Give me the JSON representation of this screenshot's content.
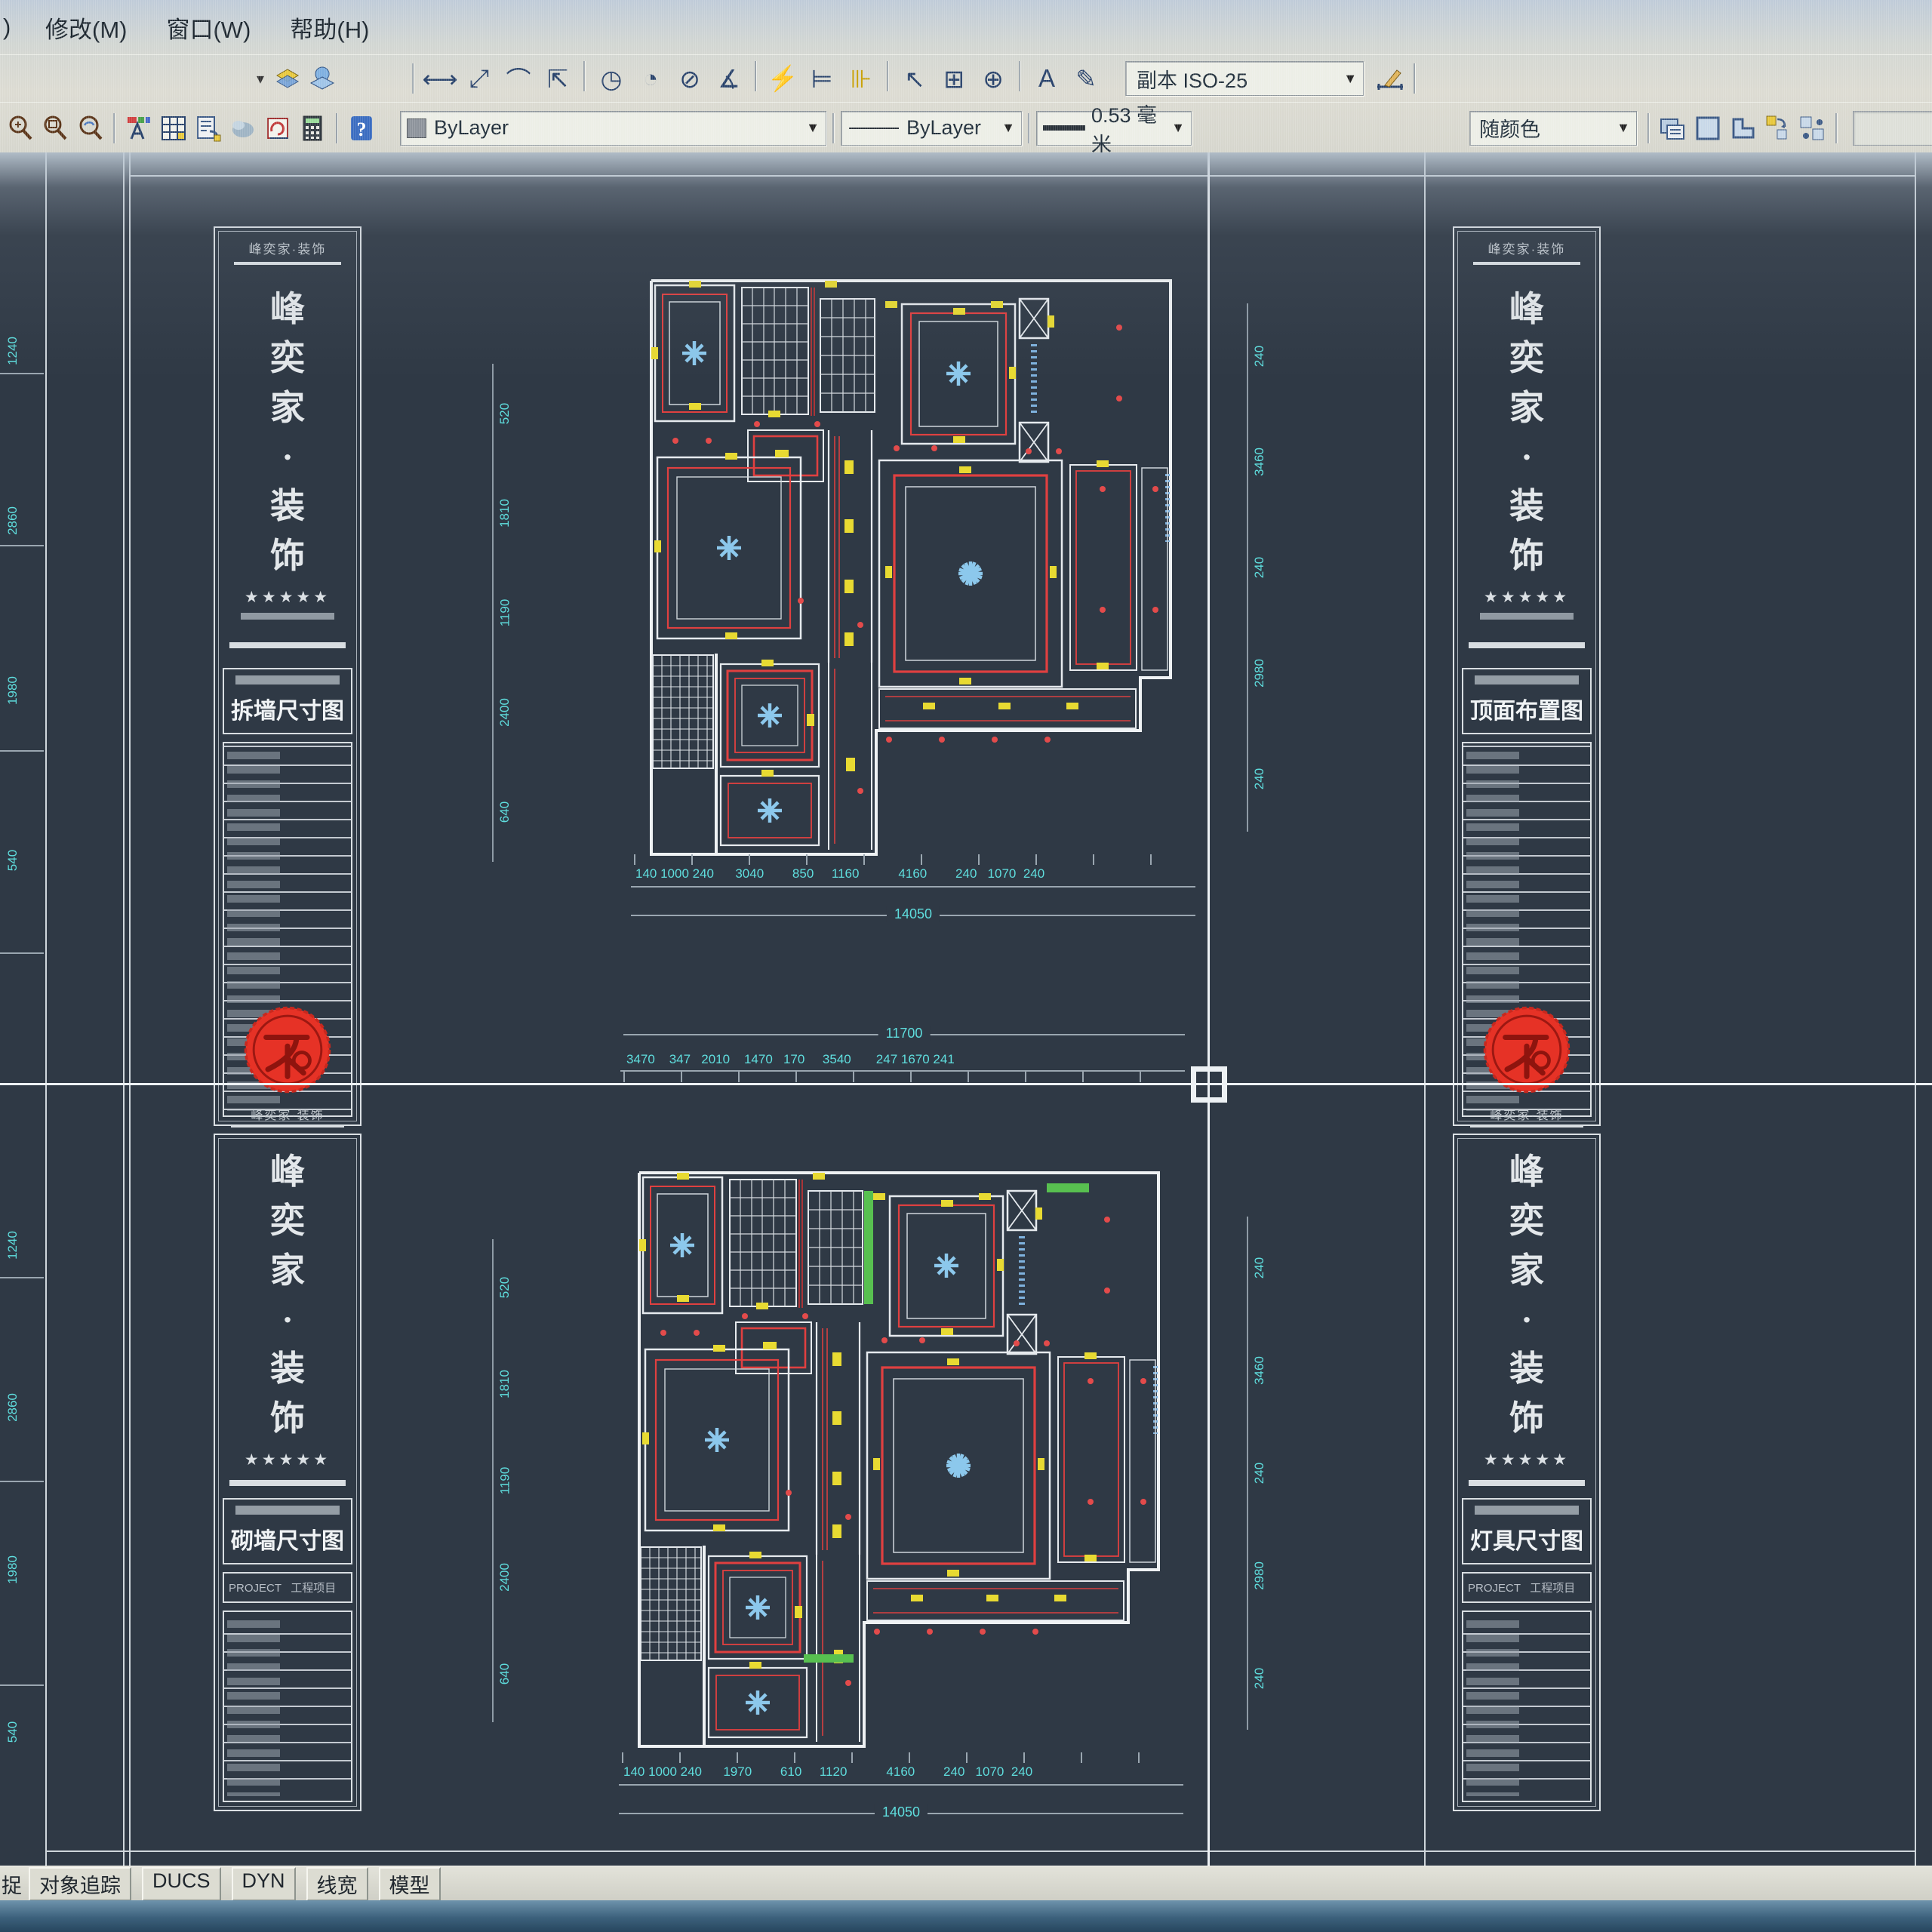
{
  "menu": {
    "left_fragment": ")",
    "items": [
      {
        "label": "修改(M)",
        "name": "menu-modify"
      },
      {
        "label": "窗口(W)",
        "name": "menu-window"
      },
      {
        "label": "帮助(H)",
        "name": "menu-help"
      }
    ]
  },
  "dim_toolbar": {
    "style_value": "副本 ISO-25",
    "icons": [
      {
        "name": "linear-dimension-icon",
        "glyph": "⟷"
      },
      {
        "name": "aligned-dimension-icon",
        "glyph": "⤢"
      },
      {
        "name": "arc-length-dimension-icon",
        "glyph": "⌒"
      },
      {
        "name": "ordinate-dimension-icon",
        "glyph": "⇱"
      },
      {
        "sep": true
      },
      {
        "name": "radius-dimension-icon",
        "glyph": "◷"
      },
      {
        "name": "jogged-dimension-icon",
        "glyph": "◔"
      },
      {
        "name": "diameter-dimension-icon",
        "glyph": "⊘"
      },
      {
        "name": "angular-dimension-icon",
        "glyph": "∡"
      },
      {
        "sep": true
      },
      {
        "name": "quick-dimension-icon",
        "glyph": "⚡"
      },
      {
        "name": "baseline-dimension-icon",
        "glyph": "⊨"
      },
      {
        "name": "continue-dimension-icon",
        "glyph": "⊪"
      },
      {
        "sep": true
      },
      {
        "name": "quick-leader-icon",
        "glyph": "↖"
      },
      {
        "name": "tolerance-icon",
        "glyph": "⊞"
      },
      {
        "name": "center-mark-icon",
        "glyph": "⊕"
      },
      {
        "sep": true
      },
      {
        "name": "dimension-edit-icon",
        "glyph": "A"
      },
      {
        "name": "dimension-text-edit-icon",
        "glyph": "✎"
      }
    ]
  },
  "props_toolbar": {
    "layer_value": "ByLayer",
    "linetype_value": "ByLayer",
    "lineweight_value": "0.53 毫米",
    "plotstyle_value": "随颜色"
  },
  "icons_registry": [
    "toolbar-overflow-arrow",
    "layer-previous-icon",
    "layer-states-icon",
    "zoom-realtime-icon",
    "zoom-window-icon",
    "zoom-previous-icon",
    "text-style-icon",
    "table-style-icon",
    "layer-translate-icon",
    "render-icon",
    "markup-icon",
    "calculator-icon",
    "help-icon",
    "dimension-update-icon",
    "print-preview-icon",
    "plot-icon",
    "page-setup-icon",
    "publish-icon",
    "batch-plot-icon"
  ],
  "statusbar": {
    "left_fragment": "捉",
    "buttons": [
      {
        "label": "对象追踪",
        "name": "status-object-tracking"
      },
      {
        "label": "DUCS",
        "name": "status-ducs"
      },
      {
        "label": "DYN",
        "name": "status-dyn"
      },
      {
        "label": "线宽",
        "name": "status-lineweight"
      },
      {
        "label": "模型",
        "name": "status-model"
      }
    ]
  },
  "titleblock": {
    "brand_header": "峰奕家·装饰",
    "brand_vertical": "峰\n奕\n家\n·\n装\n饰",
    "stars": "★★★★★",
    "project_row": "PROJECT   工程项目",
    "sheets": {
      "top_left": "拆墙尺寸图",
      "top_right": "顶面布置图",
      "bottom_left": "砌墙尺寸图",
      "bottom_right": "灯具尺寸图"
    }
  },
  "dims": {
    "top_plan": {
      "bottom_chain": "140 1000 240      3040        850     1160           4160        240   1070  240",
      "bottom_total": "14050",
      "left_chain": [
        "520",
        "1810",
        "1190",
        "2400",
        "640"
      ],
      "right_chain": [
        "240",
        "3460",
        "240",
        "2980",
        "240"
      ]
    },
    "bottom_plan": {
      "top_chain": "3470    347   2010    1470   170     3540       247 1670 241",
      "top_total": "11700",
      "bottom_chain": "140 1000 240      1970        610     1120           4160        240   1070  240",
      "bottom_total": "14050",
      "left_chain": [
        "520",
        "1810",
        "1190",
        "2400",
        "640"
      ],
      "right_chain": [
        "240",
        "3460",
        "240",
        "2980",
        "240"
      ]
    },
    "edge_left_top": [
      "1240",
      "2860",
      "1980",
      "540"
    ],
    "edge_left_bottom": [
      "1240",
      "2860",
      "1980",
      "540"
    ]
  },
  "colors": {
    "canvas_bg": "#2f3945",
    "line_white": "#e8ecef",
    "dim_cyan": "#5fdede",
    "accent_red": "#e04040",
    "accent_yellow": "#e8da32",
    "snow_blue": "#8cc8ec",
    "stamp_red": "#e63226"
  }
}
